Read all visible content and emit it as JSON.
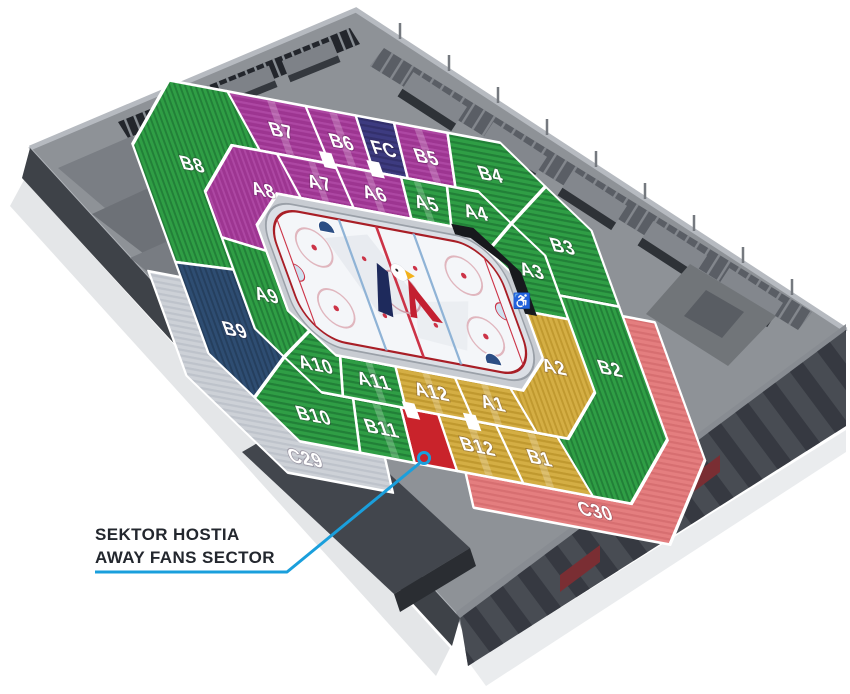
{
  "scene": {
    "description": "3D isometric seating map of an ice hockey arena (home of the eagle-logo club), viewed from above with away fans sector highlighted",
    "background": "#ffffff"
  },
  "colors": {
    "purple": "#9d3591",
    "green": "#2f9e45",
    "yellow": "#d4ae44",
    "navy_fanclub": "#3d3b80",
    "navy_b9": "#2e4d72",
    "gray_c29": "#cdd1d7",
    "pink_c30": "#e47e7f",
    "red_away": "#c9232b",
    "black_platform": "#17191d",
    "ice": "#f4f6f9",
    "rink_line_red": "#cc3347",
    "rink_line_blue": "#8fb3d6",
    "building_gray": "#8e9297",
    "callout_blue": "#1a9fdc"
  },
  "sections": {
    "A1": {
      "label": "A1",
      "color": "#d4ae44"
    },
    "A2": {
      "label": "A2",
      "color": "#d4ae44"
    },
    "A3": {
      "label": "A3",
      "color": "#2f9e45"
    },
    "A4": {
      "label": "A4",
      "color": "#2f9e45"
    },
    "A5": {
      "label": "A5",
      "color": "#2f9e45"
    },
    "A6": {
      "label": "A6",
      "color": "#9d3591"
    },
    "A7": {
      "label": "A7",
      "color": "#9d3591"
    },
    "A8": {
      "label": "A8",
      "color": "#9d3591"
    },
    "A9": {
      "label": "A9",
      "color": "#2f9e45"
    },
    "A10": {
      "label": "A10",
      "color": "#2f9e45"
    },
    "A11": {
      "label": "A11",
      "color": "#2f9e45"
    },
    "A12": {
      "label": "A12",
      "color": "#d4ae44"
    },
    "B1": {
      "label": "B1",
      "color": "#d4ae44"
    },
    "B2": {
      "label": "B2",
      "color": "#2f9e45"
    },
    "B3": {
      "label": "B3",
      "color": "#2f9e45"
    },
    "B4": {
      "label": "B4",
      "color": "#2f9e45"
    },
    "B5": {
      "label": "B5",
      "color": "#9d3591"
    },
    "B6": {
      "label": "B6",
      "color": "#9d3591"
    },
    "B7": {
      "label": "B7",
      "color": "#9d3591"
    },
    "B8": {
      "label": "B8",
      "color": "#2f9e45"
    },
    "B9": {
      "label": "B9",
      "color": "#2e4d72"
    },
    "B10": {
      "label": "B10",
      "color": "#2f9e45"
    },
    "B11": {
      "label": "B11",
      "color": "#2f9e45"
    },
    "B12": {
      "label": "B12",
      "color": "#d4ae44"
    },
    "FC": {
      "label": "FC",
      "color": "#3d3b80"
    },
    "C29": {
      "label": "C29",
      "color": "#cdd1d7"
    },
    "C30": {
      "label": "C30",
      "color": "#e47e7f"
    }
  },
  "away_sector": {
    "color": "#c9232b"
  },
  "callout": {
    "line1": "SEKTOR HOSTIA",
    "line2": "AWAY FANS SECTOR",
    "line_color": "#1a9fdc"
  },
  "icons": {
    "wheelchair": "♿"
  }
}
